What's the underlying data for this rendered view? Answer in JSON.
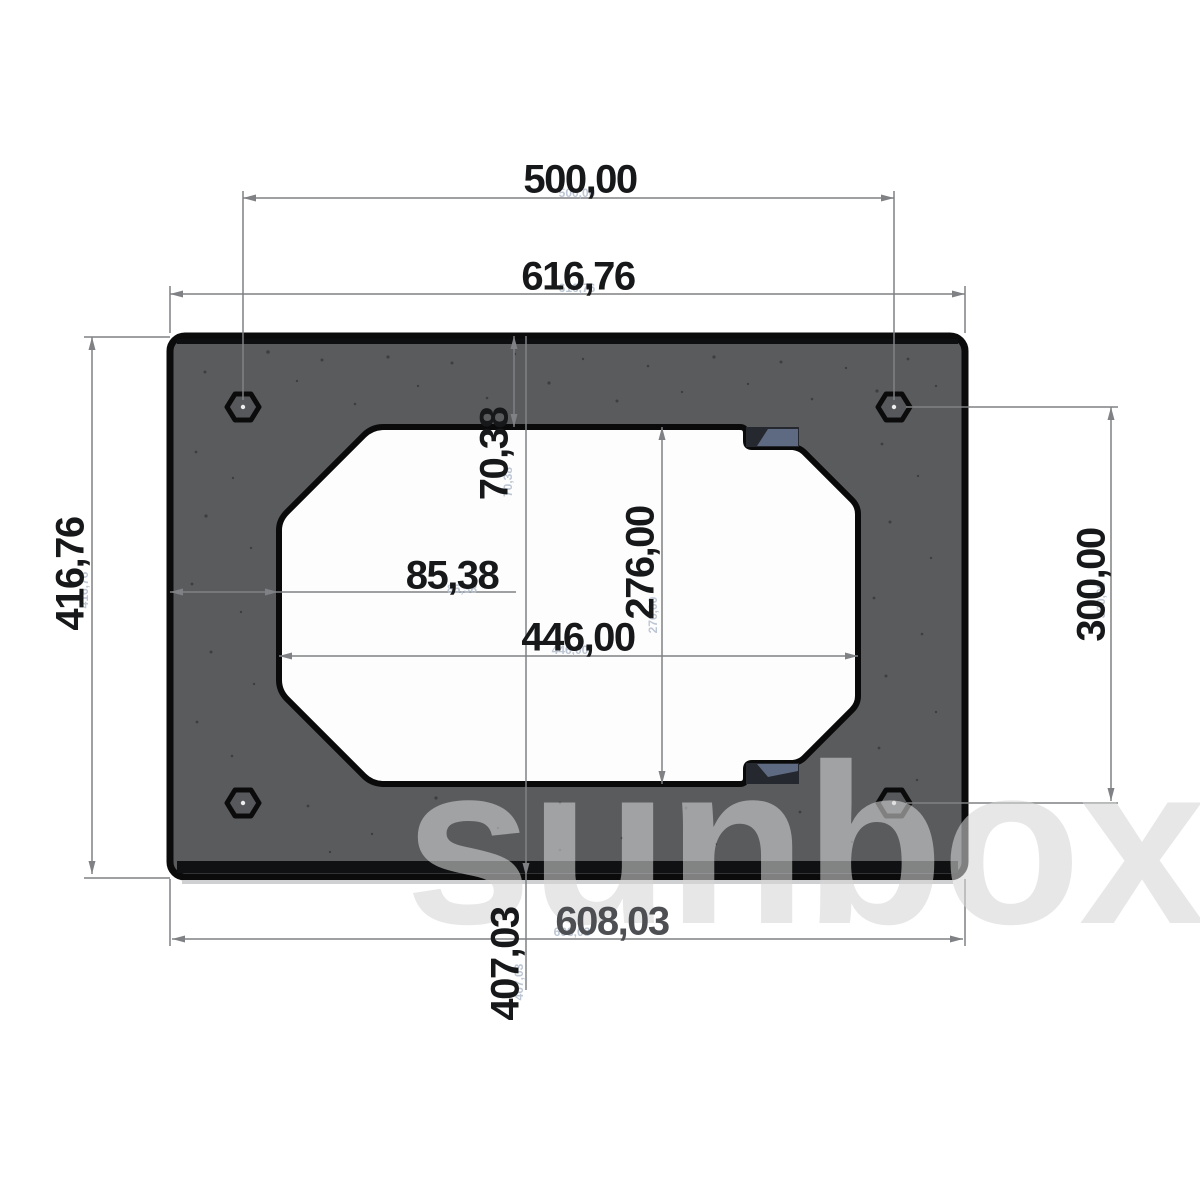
{
  "watermark_text": "sunbox",
  "dimensions": {
    "hole_spacing_x": "500,00",
    "overall_width": "616,76",
    "overall_height": "416,76",
    "hole_spacing_y": "300,00",
    "cutout_top_offset": "70,38",
    "cutout_height": "276,00",
    "cutout_left_offset": "85,38",
    "cutout_width": "446,00",
    "bottom_width": "608,03",
    "vertical_extent": "407,03"
  }
}
